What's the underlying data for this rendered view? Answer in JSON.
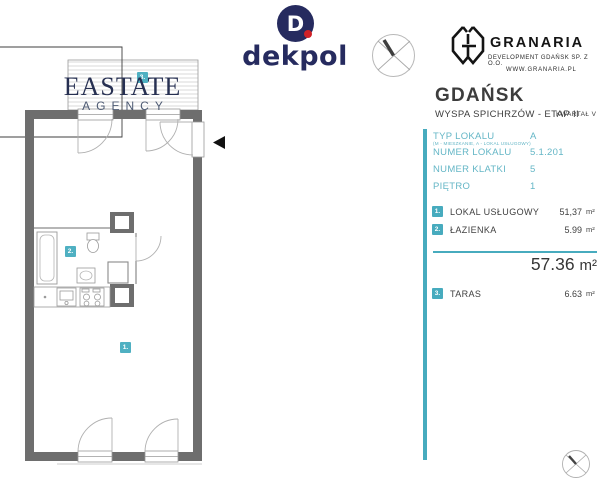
{
  "branding": {
    "dekpol": {
      "monogram": "D",
      "wordmark": "dekpol"
    },
    "granaria": {
      "name": "GRANARIA",
      "subtitle": "DEVELOPMENT GDAŃSK SP. Z O.O.",
      "website": "WWW.GRANARIA.PL"
    },
    "watermark": {
      "line1": "EASTATE",
      "line2": "AGENCY"
    }
  },
  "header": {
    "city": "GDAŃSK",
    "project": "WYSPA SPICHRZÓW - ETAP II",
    "quarter": "KWARTAŁ V"
  },
  "details": {
    "rows": [
      {
        "label": "TYP LOKALU",
        "sublabel": "(M - MIESZKANIE, A - LOKAL USŁUGOWY)",
        "value": "A"
      },
      {
        "label": "NUMER LOKALU",
        "value": "5.1.201"
      },
      {
        "label": "NUMER KLATKI",
        "value": "5"
      },
      {
        "label": "PIĘTRO",
        "value": "1"
      }
    ]
  },
  "areas": {
    "rooms": [
      {
        "no": "1.",
        "name": "LOKAL USŁUGOWY",
        "area": "51,37",
        "unit": "m²"
      },
      {
        "no": "2.",
        "name": "ŁAZIENKA",
        "area": "5.99",
        "unit": "m²"
      }
    ],
    "total": {
      "value": "57.36",
      "unit": "m²"
    },
    "extra": {
      "no": "3.",
      "name": "TARAS",
      "area": "6.63",
      "unit": "m²"
    }
  },
  "plan": {
    "badges": {
      "room1": "1.",
      "room2": "2.",
      "terrace": "3."
    }
  },
  "colors": {
    "teal": "#47abbe",
    "navy": "#262b5f",
    "red": "#d02127",
    "wall_gray": "#6e6e6e"
  }
}
